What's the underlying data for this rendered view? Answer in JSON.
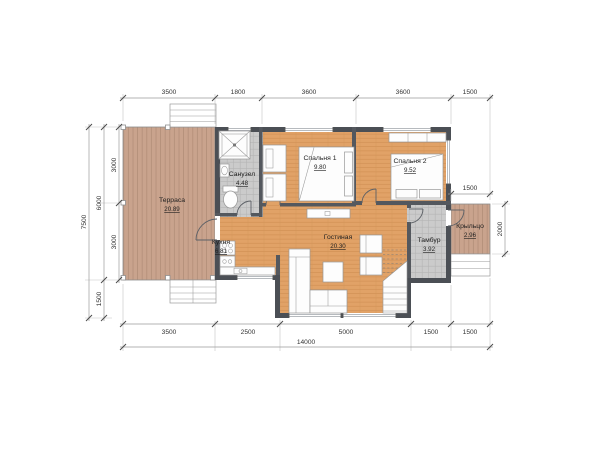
{
  "plan": {
    "rooms": {
      "terrace": {
        "name": "Терраса",
        "area": "20.89"
      },
      "bathroom": {
        "name": "Санузел",
        "area": "4.48"
      },
      "bedroom1": {
        "name": "Спальня 1",
        "area": "9.80"
      },
      "bedroom2": {
        "name": "Спальня 2",
        "area": "9.52"
      },
      "kitchen": {
        "name": "Кухня",
        "area": "6.81"
      },
      "living": {
        "name": "Гостиная",
        "area": "20.30"
      },
      "vestibule": {
        "name": "Тамбур",
        "area": "3.92"
      },
      "porch": {
        "name": "Крыльцо",
        "area": "2.96"
      }
    },
    "dims": {
      "top": {
        "d1": "3500",
        "d2": "1800",
        "d3": "3600",
        "d4": "3600",
        "d5": "1500"
      },
      "bottom": {
        "d1": "3500",
        "d2": "2500",
        "d3": "5000",
        "d4": "1500",
        "d5": "1500",
        "total": "14000"
      },
      "left": {
        "outer": "7500",
        "mid_upper": "6000",
        "mid_lower": "1500",
        "inner_upper": "3000",
        "inner_lower": "3000"
      },
      "right": {
        "porch_width": "1500",
        "porch_height": "2000"
      }
    },
    "colors": {
      "wall": "#4b4f55",
      "floor": "#e1a267",
      "deck": "#c9a38d",
      "tile": "#cccccc"
    }
  }
}
